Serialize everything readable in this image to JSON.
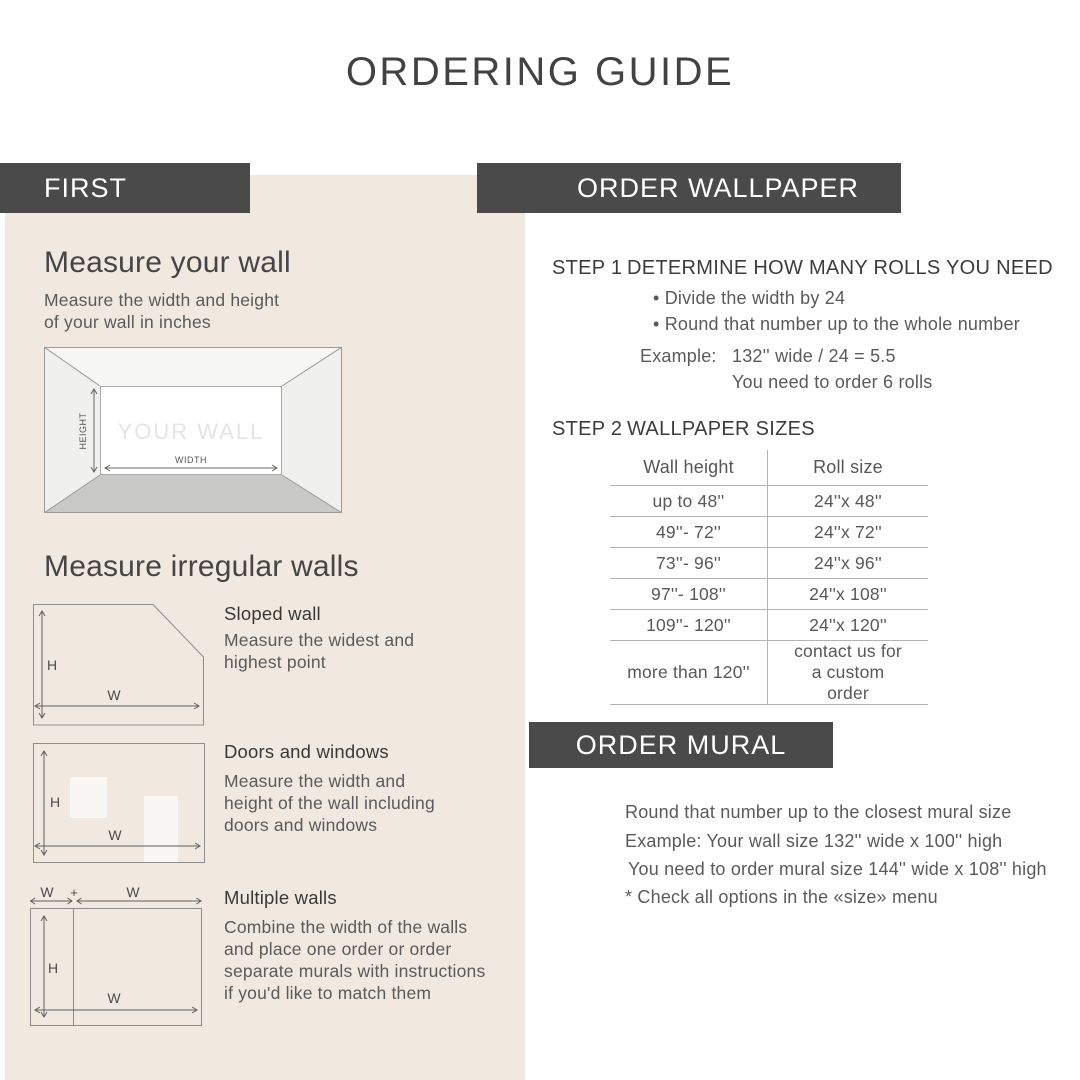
{
  "title": "ORDERING GUIDE",
  "first": {
    "band": "FIRST",
    "measure_wall": {
      "heading": "Measure your wall",
      "description": "Measure the width and height of your wall in inches",
      "diagram": {
        "label": "YOUR WALL",
        "height": "HEIGHT",
        "width": "WIDTH"
      }
    },
    "irregular": {
      "heading": "Measure irregular walls",
      "items": [
        {
          "title": "Sloped wall",
          "description": "Measure the widest and highest point",
          "h": "H",
          "w": "W"
        },
        {
          "title": "Doors and windows",
          "description": "Measure the width and height of the wall including doors and windows",
          "h": "H",
          "w": "W"
        },
        {
          "title": "Multiple walls",
          "description": "Combine the width of the walls and place one order or order separate murals with instructions if you'd like to match them",
          "h": "H",
          "w": "W",
          "w2": "W",
          "plus": "+"
        }
      ]
    }
  },
  "order_wallpaper": {
    "band": "ORDER WALLPAPER",
    "step1": {
      "label": "STEP 1",
      "title": "DETERMINE HOW MANY ROLLS YOU NEED",
      "bullets": [
        "Divide the width by 24",
        "Round that number up to the whole number"
      ],
      "example_label": "Example:",
      "example_line1": "132'' wide / 24 = 5.5",
      "example_line2": "You need to order 6 rolls"
    },
    "step2": {
      "label": "STEP 2",
      "title": "WALLPAPER SIZES",
      "table": {
        "headers": [
          "Wall height",
          "Roll size"
        ],
        "rows": [
          [
            "up to 48''",
            "24''x 48''"
          ],
          [
            "49''- 72''",
            "24''x 72''"
          ],
          [
            "73''- 96''",
            "24''x 96''"
          ],
          [
            "97''- 108''",
            "24''x 108''"
          ],
          [
            "109''- 120''",
            "24''x 120''"
          ],
          [
            "more than 120''",
            "contact us for a custom order"
          ]
        ]
      }
    }
  },
  "order_mural": {
    "band": "ORDER MURAL",
    "lines": [
      "Round that number up to the closest mural size",
      "Example: Your wall size 132'' wide x 100'' high",
      "You need to order mural size 144'' wide x 108'' high",
      "* Check all options in the «size» menu"
    ]
  },
  "colors": {
    "band_bg": "#4a4a4b",
    "band_text": "#ffffff",
    "panel_bg": "#f1e9e0",
    "heading_text": "#454545",
    "body_text": "#5a5a5a",
    "table_line": "#b3b3b3"
  }
}
